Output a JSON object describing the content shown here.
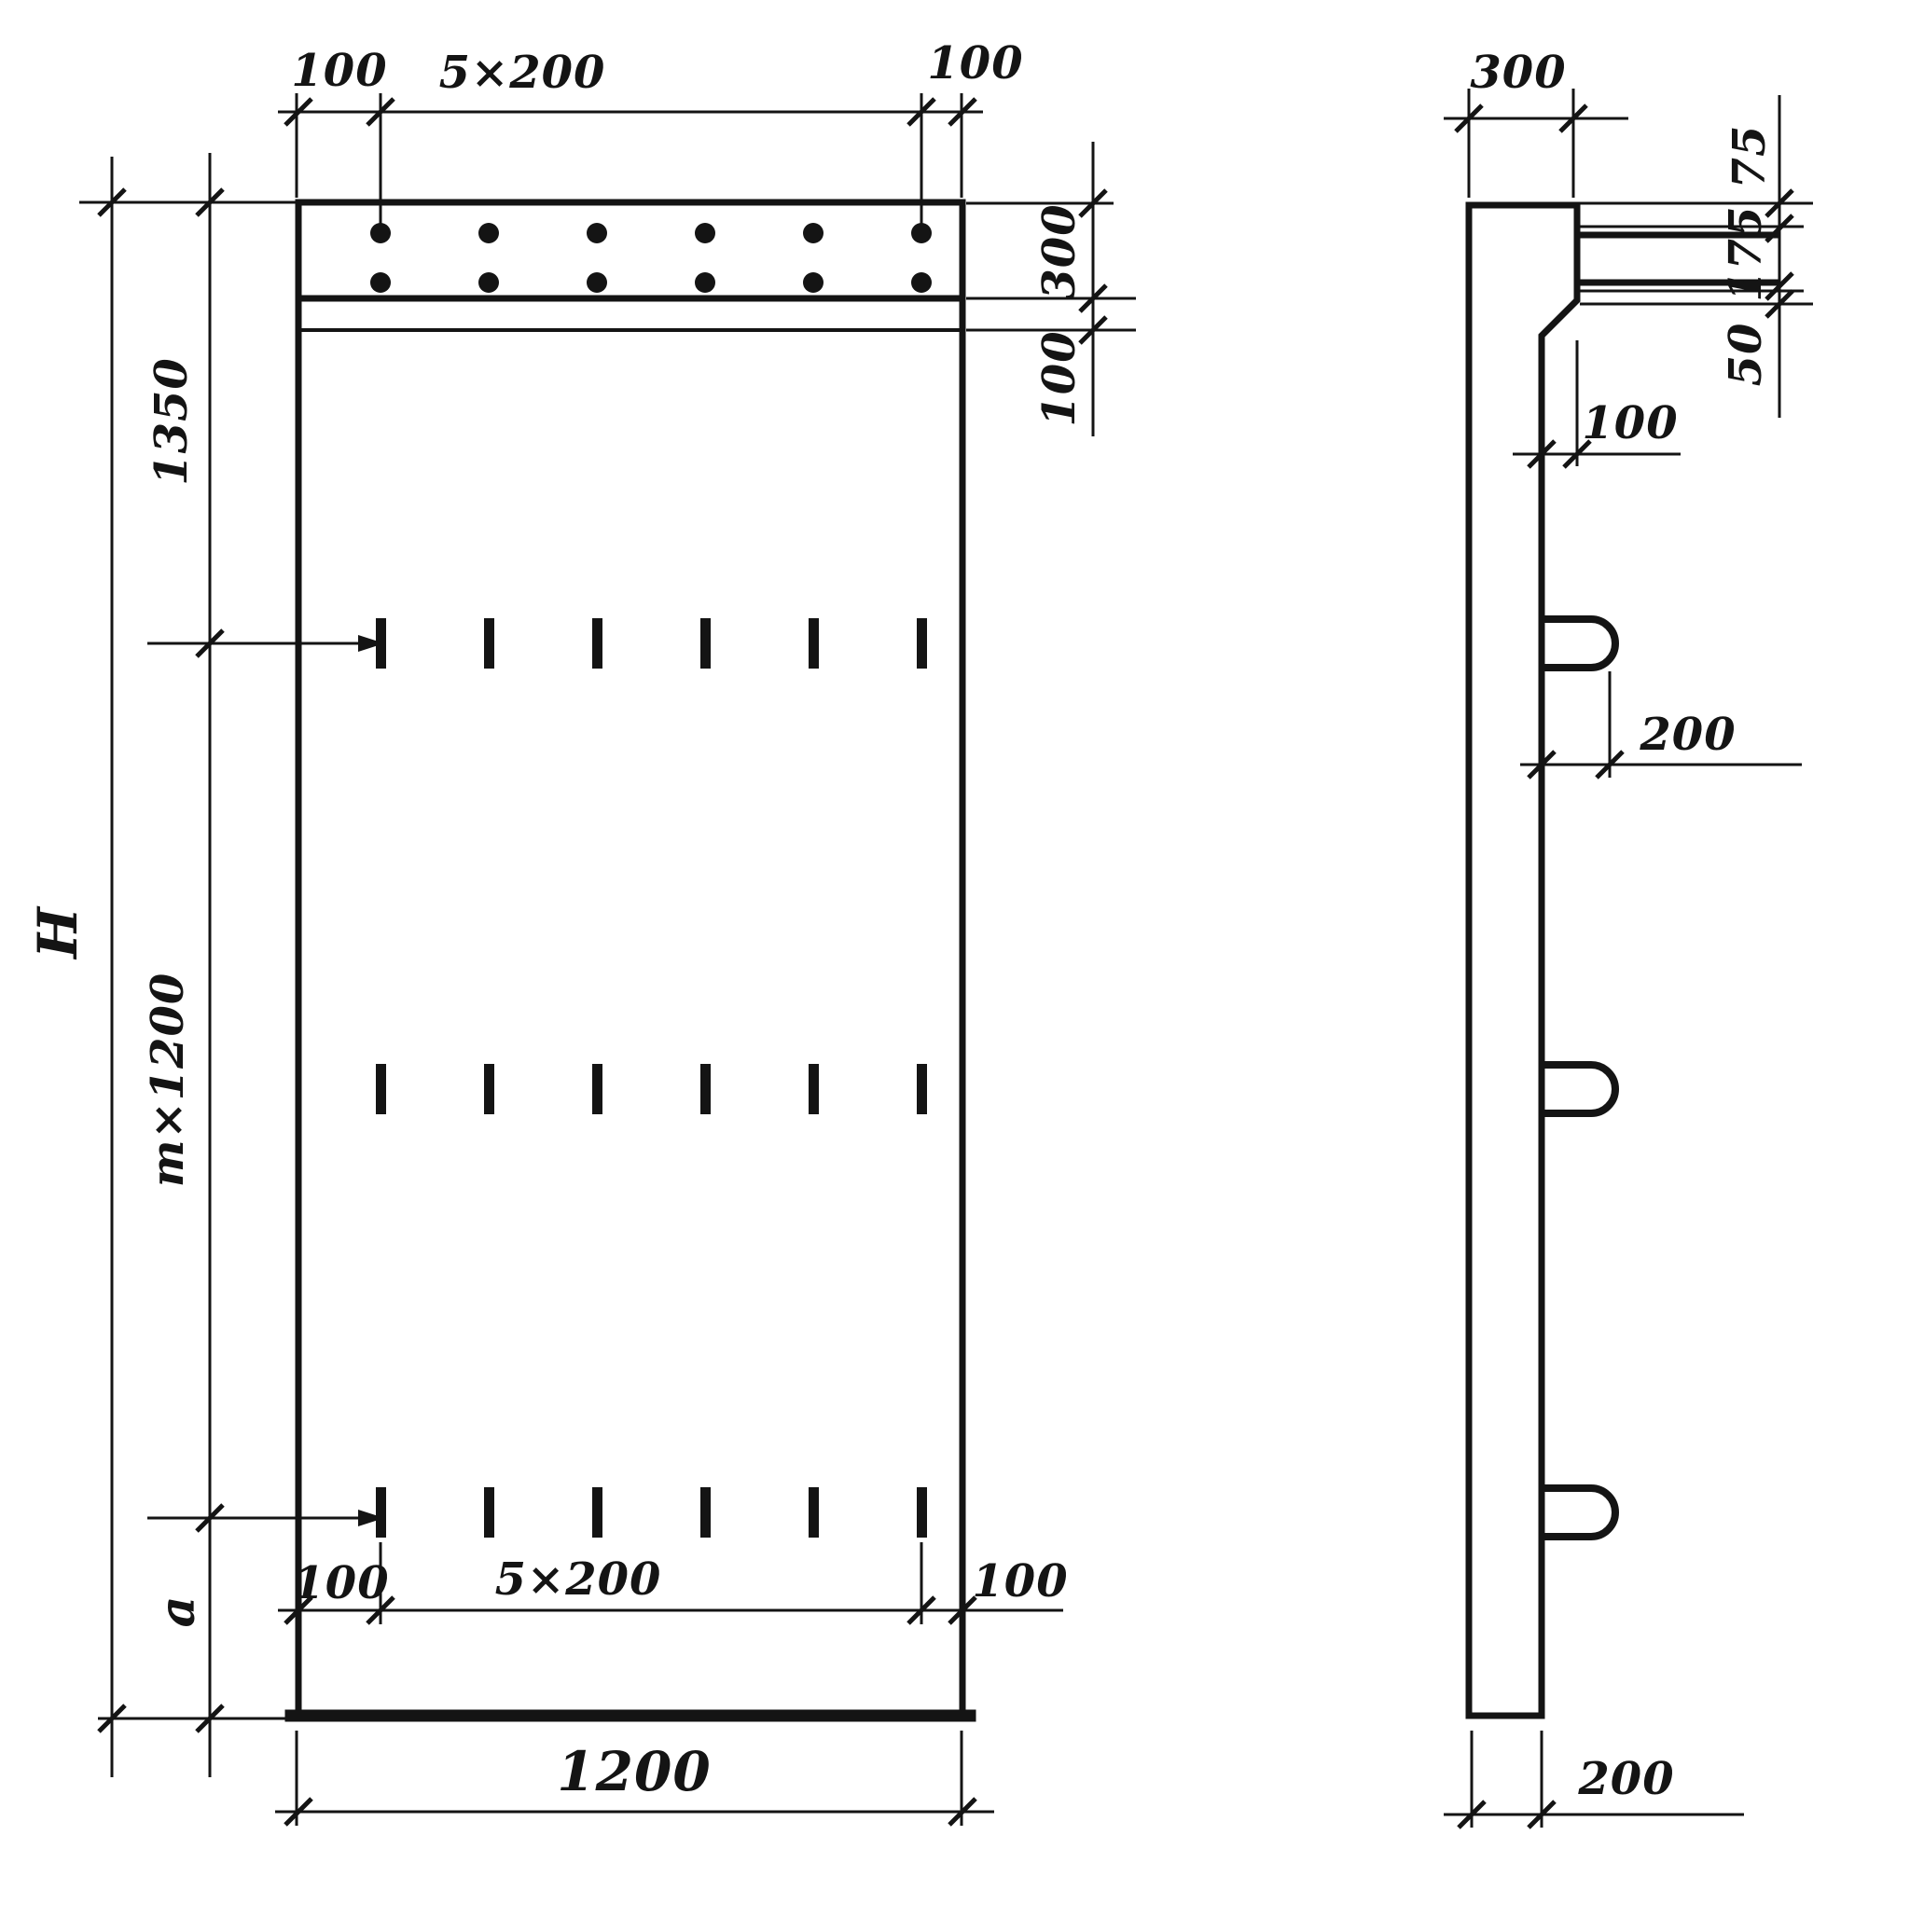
{
  "front_view": {
    "top_dim": {
      "left": "100",
      "middle": "5×200",
      "right": "100"
    },
    "right_dim": {
      "cap": "300",
      "band": "100"
    },
    "left_dim": {
      "top": "1350",
      "middle": "m×1200",
      "height": "H",
      "bottom": "a"
    },
    "bottom_dim": {
      "left": "100",
      "middle": "5×200",
      "right": "100",
      "width": "1200"
    }
  },
  "side_view": {
    "top_dim": "300",
    "right_dim": {
      "top": "75",
      "middle": "175",
      "bottom": "50"
    },
    "taper_dim": "100",
    "loop_dim": "200",
    "bottom_dim": "200"
  }
}
